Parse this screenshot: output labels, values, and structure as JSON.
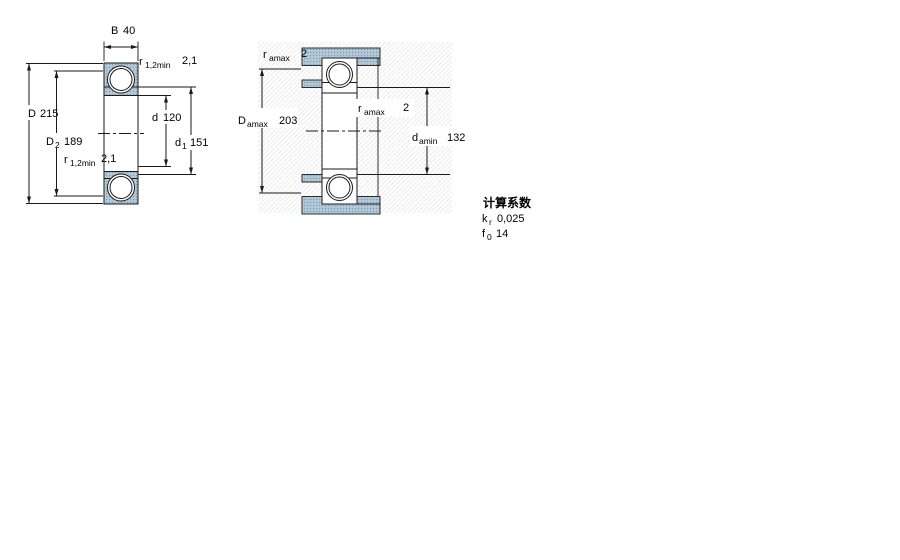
{
  "figure_left": {
    "name": "bearing cross-section (boundary dimensions)",
    "dimensions": {
      "B": {
        "label": "B",
        "value": "40"
      },
      "D": {
        "label": "D",
        "value": "215"
      },
      "D2": {
        "label": "D",
        "sub": "2",
        "value": "189"
      },
      "d": {
        "label": "d",
        "value": "120"
      },
      "d1": {
        "label": "d",
        "sub": "1",
        "value": "151"
      },
      "r_top": {
        "label": "r",
        "sub": "1,2min",
        "value": "2,1"
      },
      "r_bottom": {
        "label": "r",
        "sub": "1,2min",
        "value": "2,1"
      }
    }
  },
  "figure_right": {
    "name": "bearing mounted section (abutment dimensions)",
    "dimensions": {
      "r_a_top": {
        "label": "r",
        "sub": "amax",
        "value": "2"
      },
      "Da": {
        "label": "D",
        "sub": "amax",
        "value": "203"
      },
      "r_a_mid": {
        "label": "r",
        "sub": "amax",
        "value": "2"
      },
      "da": {
        "label": "d",
        "sub": "amin",
        "value": "132"
      }
    }
  },
  "calculation_factors": {
    "heading": "计算系数",
    "rows": [
      {
        "label": "k",
        "sub": "r",
        "value": "0,025"
      },
      {
        "label": "f",
        "sub": "0",
        "value": "14"
      }
    ]
  },
  "colors": {
    "ring_fill_base": "#b5cad9",
    "ring_fill_dot": "#7d9cb3",
    "line": "#1a1a1a",
    "hatch": "#e7e7e7",
    "background": "#ffffff"
  }
}
